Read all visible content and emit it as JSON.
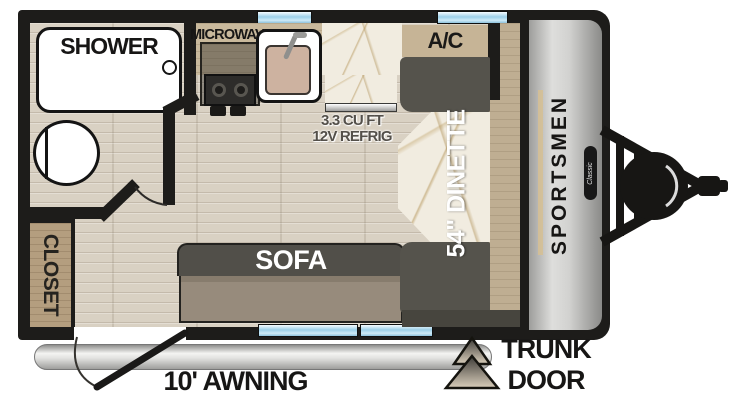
{
  "floorplan": {
    "title": "Travel trailer floor plan",
    "brand": "SPORTSMEN",
    "series_badge": "Classic",
    "bathroom": {
      "shower_label": "SHOWER"
    },
    "closet_label": "CLOSET",
    "kitchen": {
      "microwave_label": "MICROWAVE",
      "refrigerator_line1": "3.3 CU FT",
      "refrigerator_line2": "12V REFRIG"
    },
    "ac_label": "A/C",
    "dinette_label": "54\" DINETTE",
    "sofa_label": "SOFA",
    "exterior": {
      "awning_label": "10' AWNING",
      "trunk_line1": "TRUNK",
      "trunk_line2": "DOOR"
    },
    "colors": {
      "wall": "#1d1c1a",
      "floor_wood": "#d9d1c3",
      "counter_wood": "#c9b99c",
      "closet_wood": "#b49e7f",
      "bench_dark": "#55534c",
      "sofa_seat": "#978b7c",
      "marble": "#f1ece0",
      "window_blue": "#9ccfe8",
      "front_cap_gray": "#d2d2d0",
      "accent_tan": "#d6c093",
      "ac_tan": "#c6b496"
    }
  }
}
